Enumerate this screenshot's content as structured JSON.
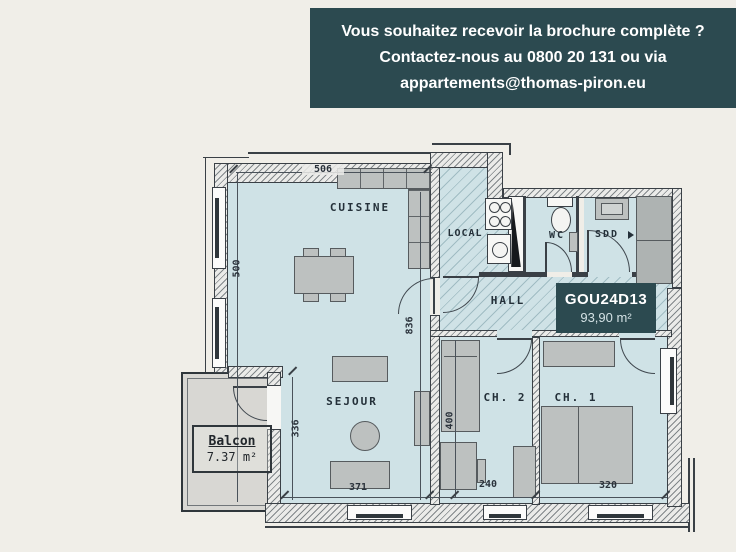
{
  "banner": {
    "lines": [
      "Vous souhaitez recevoir la brochure complète ?",
      "Contactez-nous au 0800 20 131 ou via",
      "appartements@thomas-piron.eu"
    ],
    "bg_color": "#2c4a50",
    "text_color": "#ffffff"
  },
  "floorplan": {
    "unit": {
      "code": "GOU24D13",
      "area": "93,90 m²"
    },
    "balcony": {
      "name": "Balcon",
      "area": "7.37 m²"
    },
    "rooms": {
      "cuisine": "CUISINE",
      "local": "LOCAL",
      "wc": "WC",
      "sdd": "SDD",
      "hall": "HALL",
      "sejour": "SEJOUR",
      "ch2": "CH. 2",
      "ch1": "CH. 1"
    },
    "dimensions": {
      "cuisine_width": "506",
      "cuisine_height": "500",
      "hall_wall": "836",
      "sejour_height": "336",
      "sejour_width": "371",
      "ch2_height": "400",
      "ch2_width": "240",
      "ch1_width": "320"
    },
    "colors": {
      "room_fill": "#cfe2e6",
      "wall_line": "#3a4046",
      "furniture": "#bdc1c0",
      "balcony_fill": "#d8d7d3",
      "unit_box_bg": "#2c4a50"
    }
  }
}
